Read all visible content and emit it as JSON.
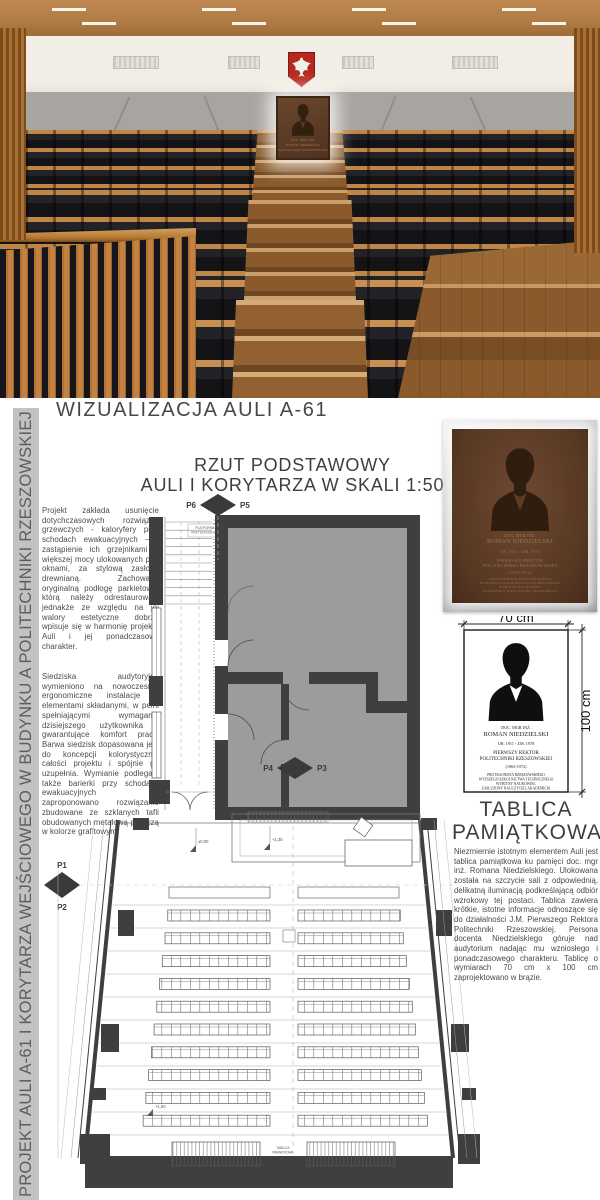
{
  "sidebar": {
    "title": "PROJEKT AULI A-61 I KORYTARZA WEJŚCIOWEGO W BUDYNKU A POLITECHNIKI RZESZOWSKIEJ"
  },
  "visualization": {
    "heading": "WIZUALIZACJA AULI A-61"
  },
  "plan": {
    "title_line1": "RZUT PODSTAWOWY",
    "title_line2": "AULI I KORYTARZA W SKALI 1:50",
    "markers": {
      "p1": "P1",
      "p2": "P2",
      "p3": "P3",
      "p4": "P4",
      "p5": "P5",
      "p6": "P6"
    },
    "labels": {
      "platform_line1": "PLATFORMA",
      "platform_line2": "PRZYSCHODOWA",
      "tablica_line1": "TABLICA",
      "tablica_line2": "PAMIĄTKOWA",
      "elev_zero": "±0,00",
      "elev_mid": "+1,35",
      "elev_back": "+1,50"
    }
  },
  "left_column": {
    "para1": "Projekt zakłada usunięcie dotychczasowych rozwiązań grzewczych - kaloryfery przy schodach ewakuacyjnych – i zastąpienie ich grzejnikami o większej mocy ulokowanych pod oknami, za stylową zasłoną drewnianą. Zachowano oryginalną podłogę parkietową, którą należy odrestaurować, jednakże ze względu na jej walory estetyczne dobrze wpisuje się w harmonię projektu Auli i jej ponadczasowy charakter.",
    "para2": "Siedziska audytoryjne wymieniono na nowoczesne, ergonomiczne instalacje z elementami składanymi, w pełni spełniającymi wymagania dzisiejszego użytkownika i gwarantujące komfort pracy. Barwa siedzisk dopasowana jest do koncepcji kolorystycznej całości projektu i spójnie go uzupełnia. Wymianie podlegają także barierki przy schodach ewakuacyjnych – zaproponowano rozwiązanie zbudowane ze szklanych tafli obudowanych metalową poręczą w kolorze grafitowym."
  },
  "plaque": {
    "lines": [
      "DOC. MGR INŻ.",
      "ROMAN NIEDZIELSKI",
      "UR. 1911 - ZM. 1978",
      "PIERWSZY REKTOR",
      "POLITECHNIKI RZESZOWSKIEJ",
      "(1963-1972)",
      "PROTAGONISTA RZESZOWSKIEGO",
      "WYŻSZEGO SZKOLNICTWA TECHNICZNEGO",
      "WYBITNY NAUKOWIEC",
      "ZASŁUŻONY NAUCZYCIEL AKADEMICKI"
    ],
    "width_dim": "70 cm",
    "height_dim": "100 cm"
  },
  "tablica_section": {
    "heading_line1": "TABLICA",
    "heading_line2": "PAMIĄTKOWA",
    "body": "Niezmiernie istotnym elementem Auli jest tablica pamiątkowa ku pamięci doc. mgr inż. Romana Niedzielskiego. Ulokowana została na szczycie sali z odpowiednią, delikatną iluminacją podkreślającą odbiór wzrokowy tej postaci. Tablica zawiera krótkie, istotne informacje odnoszące się do działalności J.M. Pierwszego Rektora Politechniki Rzeszowskiej. Persona docenta Niedzielskiego góruje nad audytorium nadając mu wzniosłego i ponadczasowego charakteru. Tablicę o wymiarach 70 cm x 100 cm zaprojektowano w brązie."
  },
  "colors": {
    "plan_wall": "#3f3f3f",
    "plan_room_fill": "#9c9c9c",
    "plaque_brown": "#5d3c26",
    "wood": "#b5722f",
    "eagle_red": "#b5281c",
    "sidebar_gray": "#c2c2c2",
    "concrete": "#a8a5a0"
  }
}
